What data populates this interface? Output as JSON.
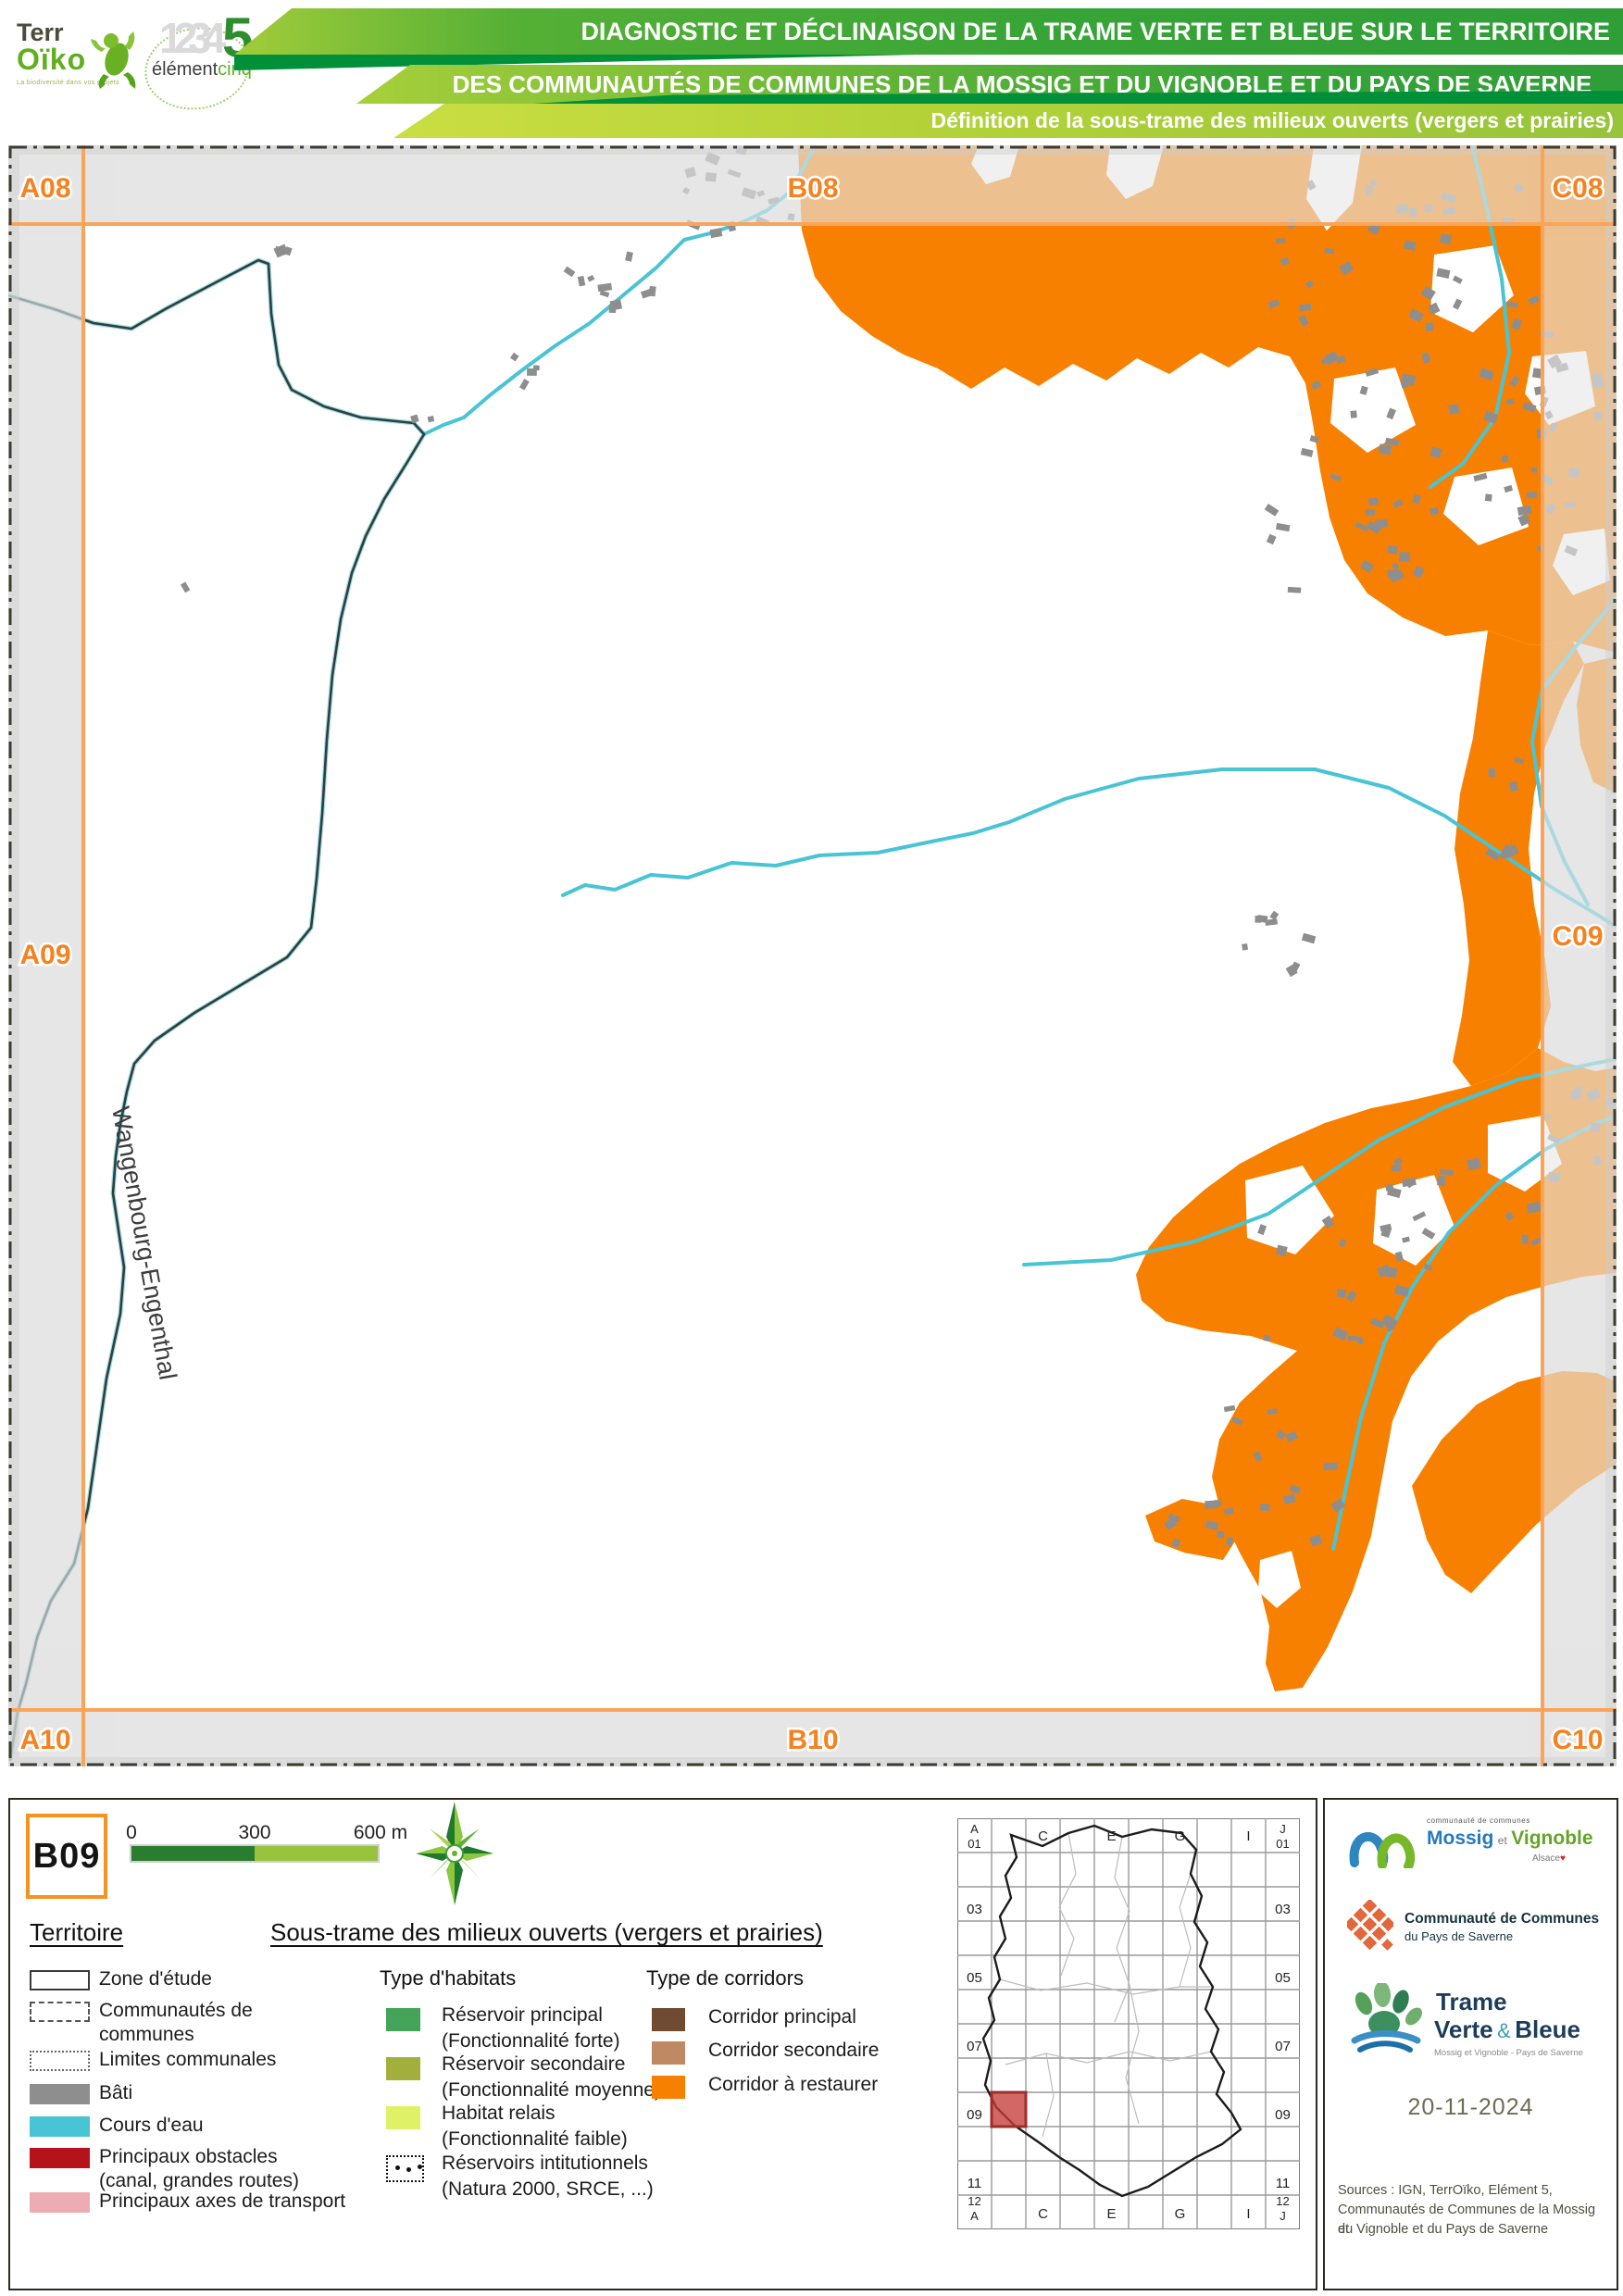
{
  "colors": {
    "accent_orange": "#F58220",
    "grid_orange": "#F9A45B",
    "corridor_restaurer": "#F88000",
    "corridor_principal": "#6E4B31",
    "corridor_secondaire": "#BF8A63",
    "reservoir_principal": "#44A45A",
    "reservoir_secondaire": "#A3AF3C",
    "habitat_relais": "#DFF266",
    "water": "#49C4D4",
    "bati": "#8E8E8E",
    "obstacle": "#B5121B",
    "axes_transport": "#EDACB3",
    "header_green": "#37A437"
  },
  "header": {
    "bar1": "DIAGNOSTIC ET DÉCLINAISON DE LA TRAME VERTE ET BLEUE SUR LE TERRITOIRE",
    "bar2": "DES COMMUNAUTÉS DE COMMUNES DE LA MOSSIG ET DU VIGNOBLE ET DU PAYS DE SAVERNE",
    "bar3": "Définition de la sous-trame des milieux ouverts (vergers et prairies)",
    "terroiko": {
      "t1": "Terr",
      "t2": "Oïko",
      "tagline": "La biodiversité dans vos projets"
    },
    "element5": {
      "ghost": "1234",
      "five": "5",
      "n1": "élément",
      "n2": "cinq"
    }
  },
  "map": {
    "labels": {
      "a08": "A08",
      "b08": "B08",
      "c08": "C08",
      "a09": "A09",
      "c09": "C09",
      "a10": "A10",
      "b10": "B10",
      "c10": "C10"
    },
    "commune": "Wangenbourg-Engenthal"
  },
  "legend": {
    "sheet_id": "B09",
    "scale_ticks": [
      "0",
      "300",
      "600 m"
    ],
    "territoire": {
      "title": "Territoire",
      "items": [
        {
          "label": "Zone d'étude"
        },
        {
          "label": "Communautés de",
          "label2": "communes"
        },
        {
          "label": "Limites communales"
        },
        {
          "label": "Bâti"
        },
        {
          "label": "Cours d'eau"
        },
        {
          "label": "Principaux obstacles",
          "label2": "(canal, grandes routes)"
        },
        {
          "label": "Principaux axes de transport"
        }
      ]
    },
    "soustrame_title": "Sous-trame des milieux ouverts (vergers et prairies)",
    "habitats": {
      "title": "Type d'habitats",
      "items": [
        {
          "label": "Réservoir principal",
          "label2": "(Fonctionnalité forte)"
        },
        {
          "label": "Réservoir secondaire",
          "label2": "(Fonctionnalité moyenne)"
        },
        {
          "label": "Habitat relais",
          "label2": "(Fonctionnalité faible)"
        },
        {
          "label": "Réservoirs intitutionnels",
          "label2": "(Natura 2000, SRCE, ...)"
        }
      ]
    },
    "corridors": {
      "title": "Type de corridors",
      "items": [
        {
          "label": "Corridor principal"
        },
        {
          "label": "Corridor secondaire"
        },
        {
          "label": "Corridor à restaurer"
        }
      ]
    }
  },
  "index_map": {
    "corner_tl_letter": "A",
    "corner_tl_num": "01",
    "corner_tr_letter": "J",
    "corner_tr_num": "01",
    "corner_bl_num": "12",
    "corner_bl_letter": "A",
    "corner_br_num": "12",
    "corner_br_letter": "J",
    "row_labels": [
      "03",
      "05",
      "07",
      "09",
      "11"
    ],
    "col_labels": [
      "C",
      "E",
      "G",
      "I"
    ]
  },
  "credits": {
    "mossig": {
      "small": "communauté de communes",
      "name1": "Mossig",
      "et": "et",
      "name2": "Vignoble",
      "region": "Alsace"
    },
    "saverne": {
      "line1": "Communauté de Communes",
      "line2": "du Pays de Saverne"
    },
    "tvb": {
      "line1": "Trame",
      "v": "Verte",
      "amp": "&",
      "b": "Bleue",
      "subtitle": "Mossig et Vignoble - Pays de Saverne"
    },
    "date": "20-11-2024",
    "sources": [
      "Sources : IGN, TerrOïko, Elément 5,",
      "Communautés de Communes de la Mossig et",
      "du Vignoble et du Pays de Saverne"
    ]
  }
}
